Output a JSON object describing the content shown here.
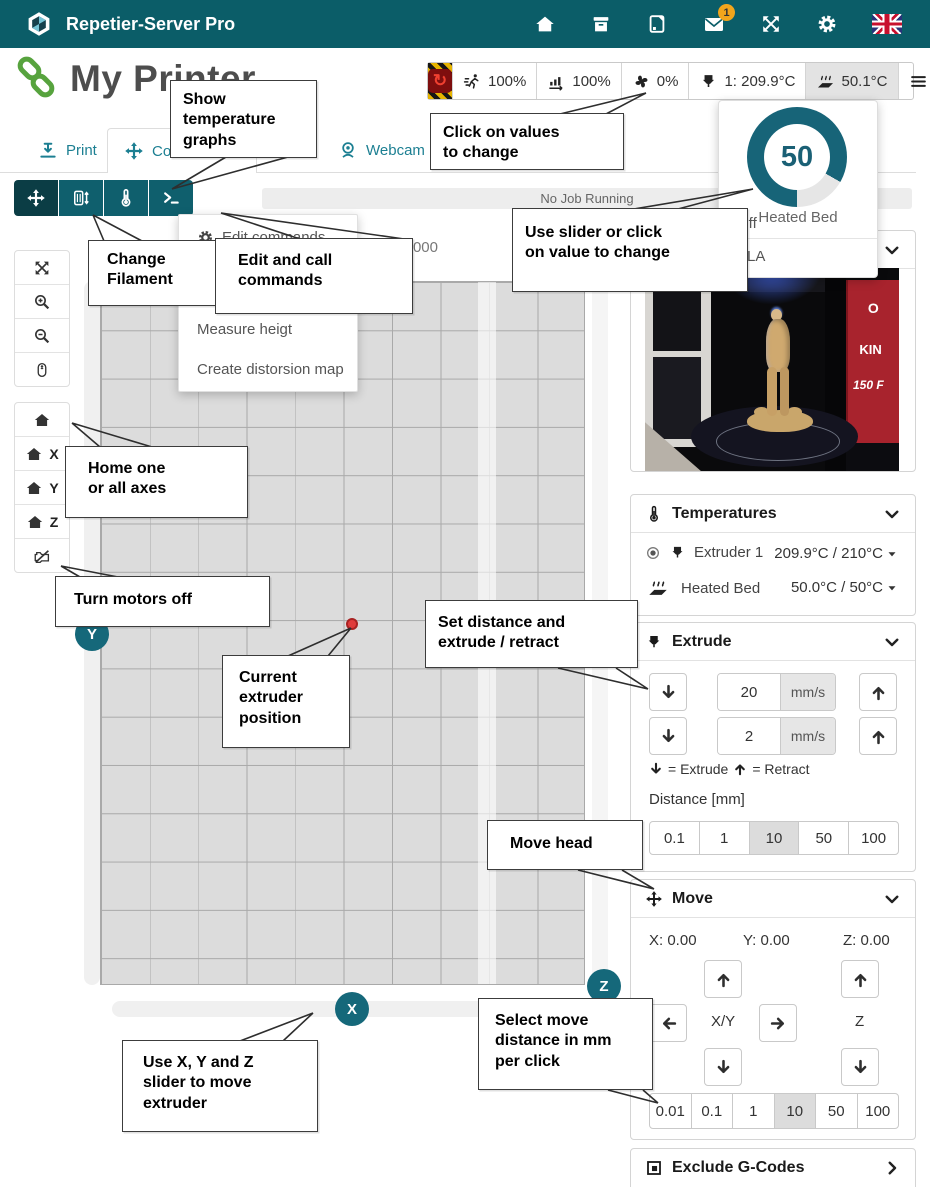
{
  "colors": {
    "accent_teal": "#177C8E",
    "navbar": "#0B5D68",
    "handle": "#15687A",
    "gauge": "#176478",
    "hazard_yellow": "#E6B400",
    "red_dot": "#E03C3C",
    "selected_bg": "#DCDCDC"
  },
  "navbar": {
    "title": "Repetier-Server Pro",
    "mail_badge": "1"
  },
  "header": {
    "printer_name": "My Printer",
    "status": {
      "speed": "100%",
      "flow": "100%",
      "fan": "0%",
      "extruder": "1: 209.9°C",
      "bed": "50.1°C"
    }
  },
  "tabs": {
    "print": "Print",
    "control": "Control",
    "webcam": "Webcam"
  },
  "job": {
    "status": "No Job Running",
    "z_readout": "Z: 0.000"
  },
  "menu": {
    "item_edit": "Edit commands",
    "item_ca": "Ca",
    "item_measure": "Measure heigt",
    "item_distortion": "Create distorsion map"
  },
  "bed_popup": {
    "value": "50",
    "label": "Heated Bed",
    "state": "Off",
    "material": "PLA"
  },
  "temps": {
    "title": "Temperatures",
    "extruder": {
      "label": "Extruder 1",
      "value": "209.9°C / 210°C"
    },
    "bed": {
      "label": "Heated Bed",
      "value": "50.0°C / 50°C"
    }
  },
  "extrude": {
    "title": "Extrude",
    "speed_fast": "20",
    "speed_slow": "2",
    "unit1": "mm/s",
    "unit2": "mm/s",
    "legend_extrude": "= Extrude",
    "legend_retract": "= Retract",
    "distance_label": "Distance [mm]",
    "distances": [
      "0.1",
      "1",
      "10",
      "50",
      "100"
    ]
  },
  "move": {
    "title": "Move",
    "x": "X: 0.00",
    "y": "Y: 0.00",
    "z": "Z: 0.00",
    "xy": "X/Y",
    "z_col": "Z",
    "distances": [
      "0.01",
      "0.1",
      "1",
      "10",
      "50",
      "100"
    ]
  },
  "exclude": {
    "title": "Exclude G-Codes"
  },
  "axes": {
    "x": "X",
    "y": "Y",
    "z": "Z"
  },
  "home": {
    "x": "X",
    "y": "Y",
    "z": "Z"
  },
  "webcam_sign": {
    "line1": "O",
    "line2": "KIN",
    "line3": "150 F"
  },
  "callouts": {
    "show_temp": "Show\ntemperature\ngraphs",
    "click_values": "Click on values\nto change",
    "use_slider": "Use slider or click\non value to change",
    "change_filament": "Change\nFilament",
    "edit_commands": "Edit and call\ncommands",
    "home_axes": "Home one\nor all axes",
    "motors_off": "Turn motors off",
    "extruder_pos": "Current\nextruder\nposition",
    "set_distance": "Set distance and\nextrude / retract",
    "move_head": "Move head",
    "xyz_slider": "Use X, Y and Z\nslider to move\nextruder",
    "select_move": "Select move\ndistance in mm\nper click"
  }
}
